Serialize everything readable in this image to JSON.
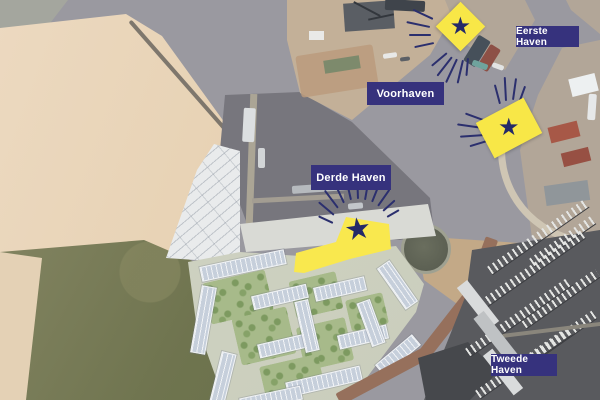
{
  "map": {
    "labels": {
      "eerste_haven": "Eerste Haven",
      "voorhaven": "Voorhaven",
      "derde_haven": "Derde Haven",
      "tweede_haven": "Tweede Haven"
    },
    "icons": {
      "star": "★"
    },
    "colors": {
      "label_background": "#36327D",
      "label_text": "#FFFFFF",
      "marker_yellow": "#F8E747",
      "star_navy": "#242A68",
      "ray_navy": "#2B2F6E",
      "highlight_yellow": "#F9E84E"
    }
  }
}
